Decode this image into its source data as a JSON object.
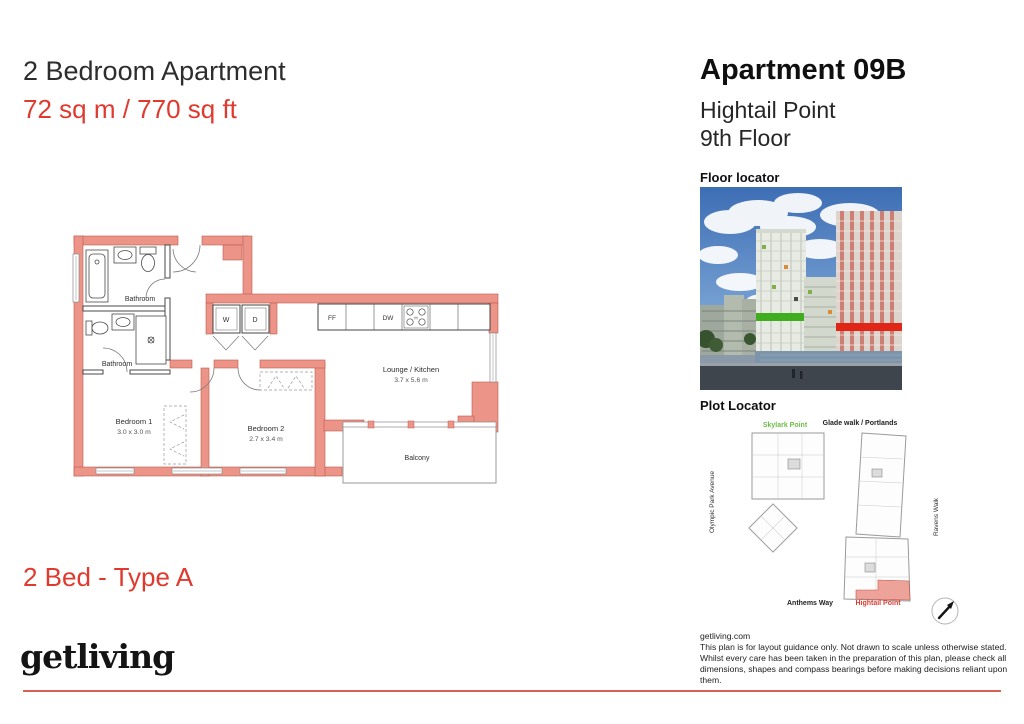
{
  "header": {
    "title": "2 Bedroom Apartment",
    "area": "72 sq m / 770 sq ft"
  },
  "apartment": {
    "number": "Apartment 09B",
    "building": "Hightail Point",
    "floor": "9th Floor"
  },
  "plan": {
    "type_label": "2 Bed - Type A",
    "rooms": {
      "bathroom1": "Bathroom",
      "bathroom2": "Bathroom",
      "bedroom1": {
        "name": "Bedroom 1",
        "dims": "3.0 x 3.0 m"
      },
      "bedroom2": {
        "name": "Bedroom 2",
        "dims": "2.7 x 3.4 m"
      },
      "lounge": {
        "name": "Lounge / Kitchen",
        "dims": "3.7 x 5.6 m"
      },
      "balcony": "Balcony"
    },
    "appliances": {
      "washer": "W",
      "dryer": "D",
      "fridge": "FF",
      "dishwasher": "DW",
      "hob": "H"
    }
  },
  "floor_locator": {
    "label": "Floor locator"
  },
  "plot_locator": {
    "label": "Plot Locator",
    "skylark": "Skylark Point",
    "glade": "Glade walk / Portlands",
    "hightail": "Hightail Point",
    "street_left": "Olympic Park Avenue",
    "street_right": "Ravens Walk",
    "street_bottom": "Anthems Way"
  },
  "footer": {
    "logo": "getliving",
    "website": "getliving.com",
    "disclaimer": "This plan is for layout guidance only. Not drawn to scale unless otherwise stated. Whilst every care has been taken in the preparation of this plan, please check all dimensions, shapes and compass bearings before making decisions reliant upon them."
  },
  "colors": {
    "accent_red": "#E0392E",
    "wall_fill": "#EC9488",
    "skylark_green": "#6CBD45",
    "highlight_fill": "#EDA39A"
  }
}
